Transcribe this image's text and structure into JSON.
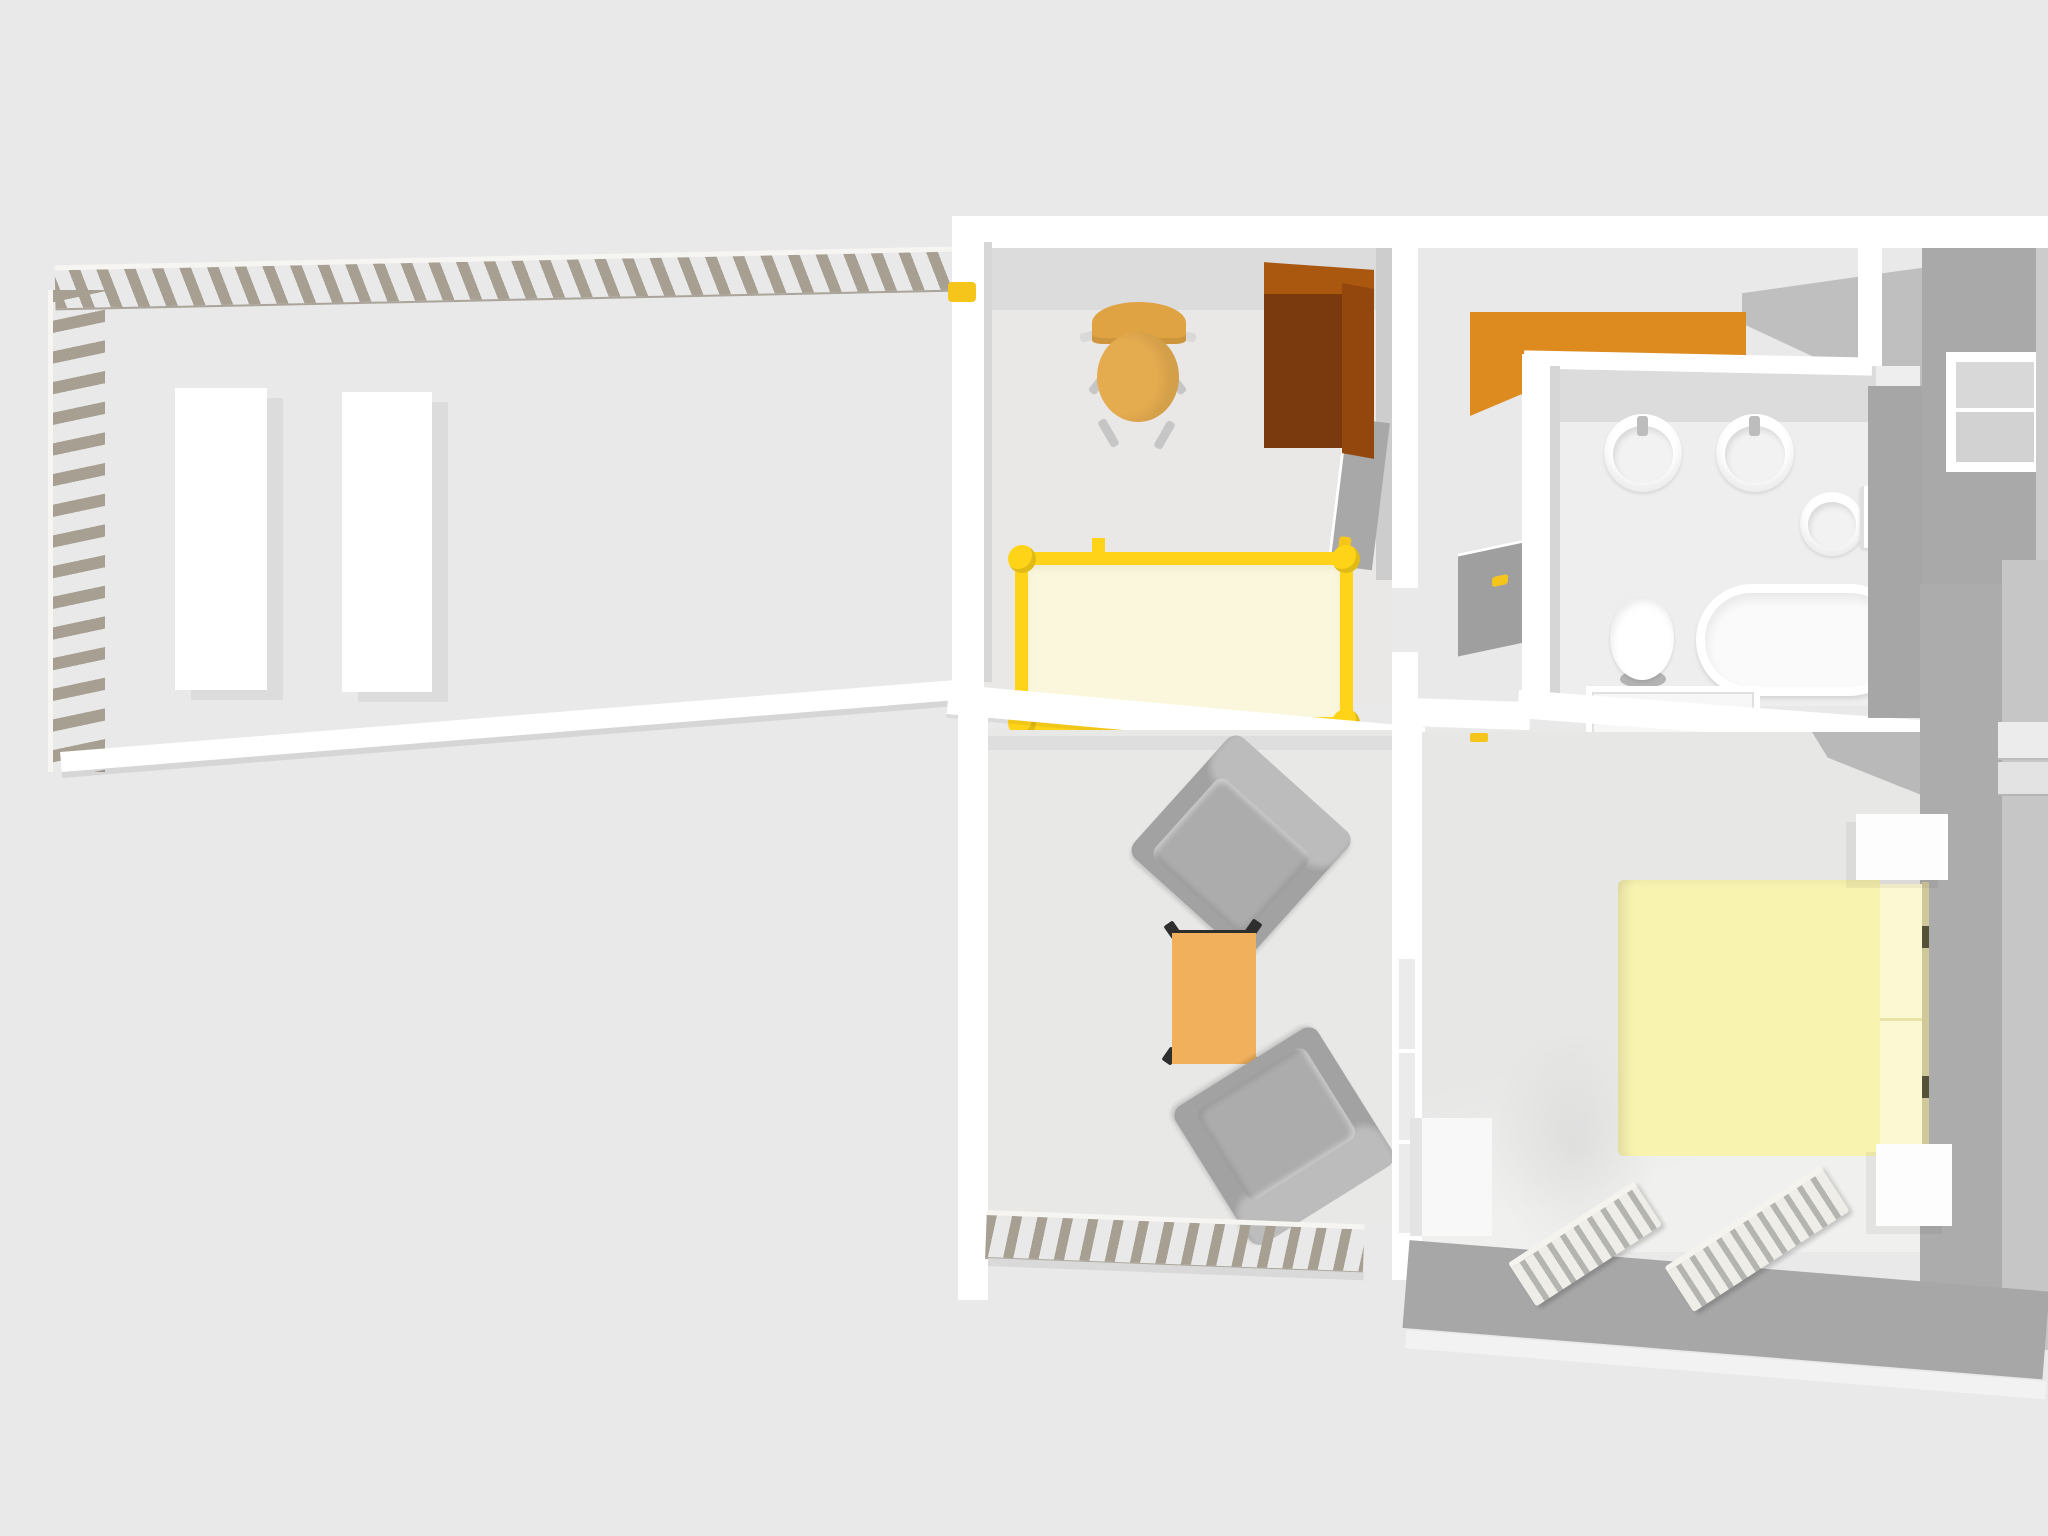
{
  "scene": {
    "type": "3d-floor-plan-overhead-render",
    "application": "home-design-3d-viewport",
    "rooms": [
      {
        "id": "terrace",
        "furniture": [
          "railing-top",
          "railing-left",
          "sun-lounger-1",
          "sun-lounger-2"
        ]
      },
      {
        "id": "nursery",
        "furniture": [
          "wooden-chair",
          "brown-wardrobe",
          "yellow-crib",
          "room-door"
        ]
      },
      {
        "id": "hallway",
        "furniture": [
          "orange-counter",
          "bathroom-door"
        ]
      },
      {
        "id": "bathroom",
        "furniture": [
          "sink-1",
          "sink-2",
          "wall-basin",
          "toilet",
          "bathtub",
          "cabinet",
          "window"
        ]
      },
      {
        "id": "living-room",
        "furniture": [
          "armchair-1",
          "coffee-table",
          "armchair-2",
          "balcony-railing",
          "glass-door"
        ]
      },
      {
        "id": "bedroom",
        "furniture": [
          "double-bed",
          "nightstand-1",
          "nightstand-2",
          "dresser",
          "radiator-1",
          "radiator-2",
          "wall-shelves"
        ]
      }
    ]
  },
  "palette": {
    "bg": "#e9e9e9",
    "wallWhite": "#ffffff",
    "wallFaceLight": "#dcdcdc",
    "wallFaceMid": "#bfbfbf",
    "wallFaceDark": "#a9a9a9",
    "darkBand": "#a7a7a7",
    "railing": "#a79f92",
    "wardrobeFront": "#7b3a0e",
    "wardrobeTop": "#aa570f",
    "wardrobeSide": "#93470c",
    "orangeCounter": "#dd8a1e",
    "chairSeat": "#e4ab4f",
    "chairBack": "#dfa343",
    "cribFrame": "#ffd418",
    "cribMattress": "#fbf7dc",
    "tableTop": "#f1b15c",
    "armchairBase": "#a2a2a2",
    "armchairBack": "#bcbcbc",
    "armchairCushion": "#acacac",
    "bedDuvet": "#f9f3b0",
    "bedPillow": "#fcf8d2",
    "bedHeadboard": "#cfc89b",
    "fixtureWhite": "#ffffff",
    "glass": "#d8d8d8",
    "handleYellow": "#f6c51b"
  }
}
